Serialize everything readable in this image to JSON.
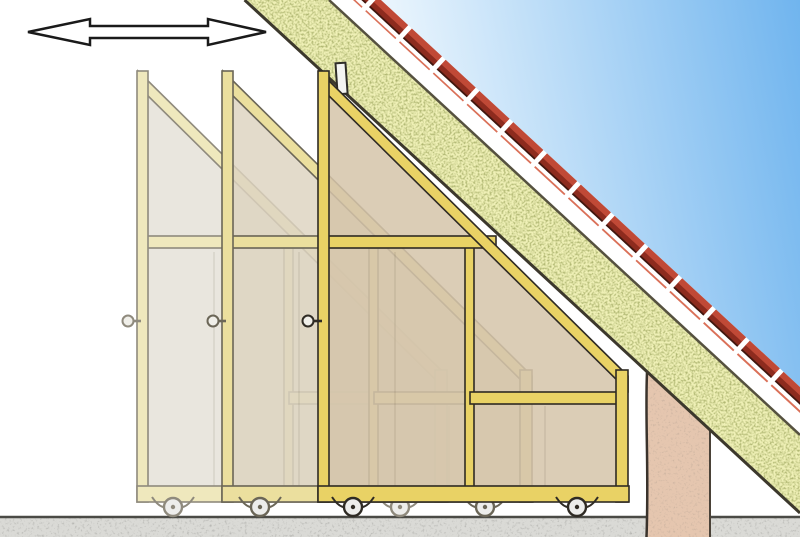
{
  "scene": {
    "description": "Cross-section illustration of three triangular sliding panels on caster wheels closing off knee-wall storage space beneath a pitched, insulated roof",
    "arrow_meaning": "panels slide horizontally left-right",
    "element_names": [
      "double-arrow-icon",
      "roof-tiles",
      "roof-insulation",
      "roof-deck",
      "guide-bracket",
      "sliding-panel-back",
      "sliding-panel-middle",
      "sliding-panel-front",
      "knob",
      "caster-wheel",
      "eaves-post",
      "floor"
    ]
  },
  "colors": {
    "sky_deep": "#6db3ee",
    "sky_light": "#eaf5fd",
    "tile_red": "#c04936",
    "tile_dark": "#8d2b1e",
    "tile_light": "#da7058",
    "tile_edge": "#3f150d",
    "insulation": "#eff0b6",
    "insulation_speckle": "#6b7529",
    "post": "#e5c6af",
    "post_speckle": "#8c6b54",
    "floor": "#dadad6",
    "floor_speckle": "#6b6b66",
    "arrow_fill": "#ffffff",
    "bracket": "#f4f4f2",
    "wheel": "#ededeb",
    "knob": "#f0efe9",
    "ink": "#2f2d28"
  },
  "panels": [
    {
      "name": "sliding-panel-back",
      "left_x": 137,
      "frame": "#efe8bd",
      "body": "#e7e3da",
      "ink": "#8f8a7d",
      "body_opacity": 0.9,
      "knob_x": 128,
      "wheels": [
        173,
        400
      ]
    },
    {
      "name": "sliding-panel-middle",
      "left_x": 222,
      "frame": "#ebdf9e",
      "body": "#ddd3c0",
      "ink": "#6b6657",
      "body_opacity": 0.82,
      "knob_x": 213,
      "wheels": [
        260,
        485
      ]
    },
    {
      "name": "sliding-panel-front",
      "left_x": 318,
      "frame": "#e9d265",
      "body": "#d5c4a9",
      "ink": "#2f2b24",
      "body_opacity": 0.85,
      "knob_x": 308,
      "wheels": [
        353,
        577
      ]
    }
  ]
}
